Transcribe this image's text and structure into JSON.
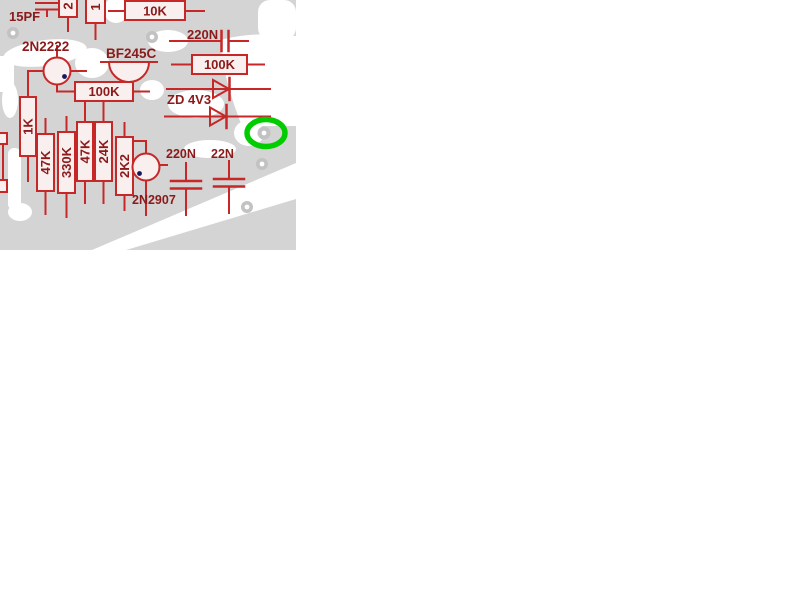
{
  "figure": {
    "description": "Red circuit schematic overlaid on gray PCB copper artwork, with a green ellipse highlight mark",
    "colors": {
      "copper": "#d4d4d4",
      "board_bg": "#ffffff",
      "trace": "#c62828",
      "component_fill": "#f9efee",
      "label": "#8b1a1a",
      "junction_dot": "#16165e",
      "pad_ring": "#c2c2c2",
      "highlight": "#00cc00"
    },
    "labels": {
      "c15pf": "15PF",
      "r_top_a_fragment": "2",
      "r_top_b_fragment": "1",
      "r10k": "10K",
      "q2n2222": "2N2222",
      "qbf245c": "BF245C",
      "c220n_top": "220N",
      "r100k_right": "100K",
      "zener": "ZD 4V3",
      "r100k_left": "100K",
      "r1k": "1K",
      "r47k_a": "47K",
      "r330k": "330K",
      "r47k_b": "47K",
      "r24k": "24K",
      "r2k2": "2K2",
      "q2n2907": "2N2907",
      "c220n_bottom": "220N",
      "c22n": "22N"
    },
    "annotation": {
      "shape": "ellipse",
      "color": "#00cc00",
      "meaning": "highlighted pad on pcb"
    }
  }
}
